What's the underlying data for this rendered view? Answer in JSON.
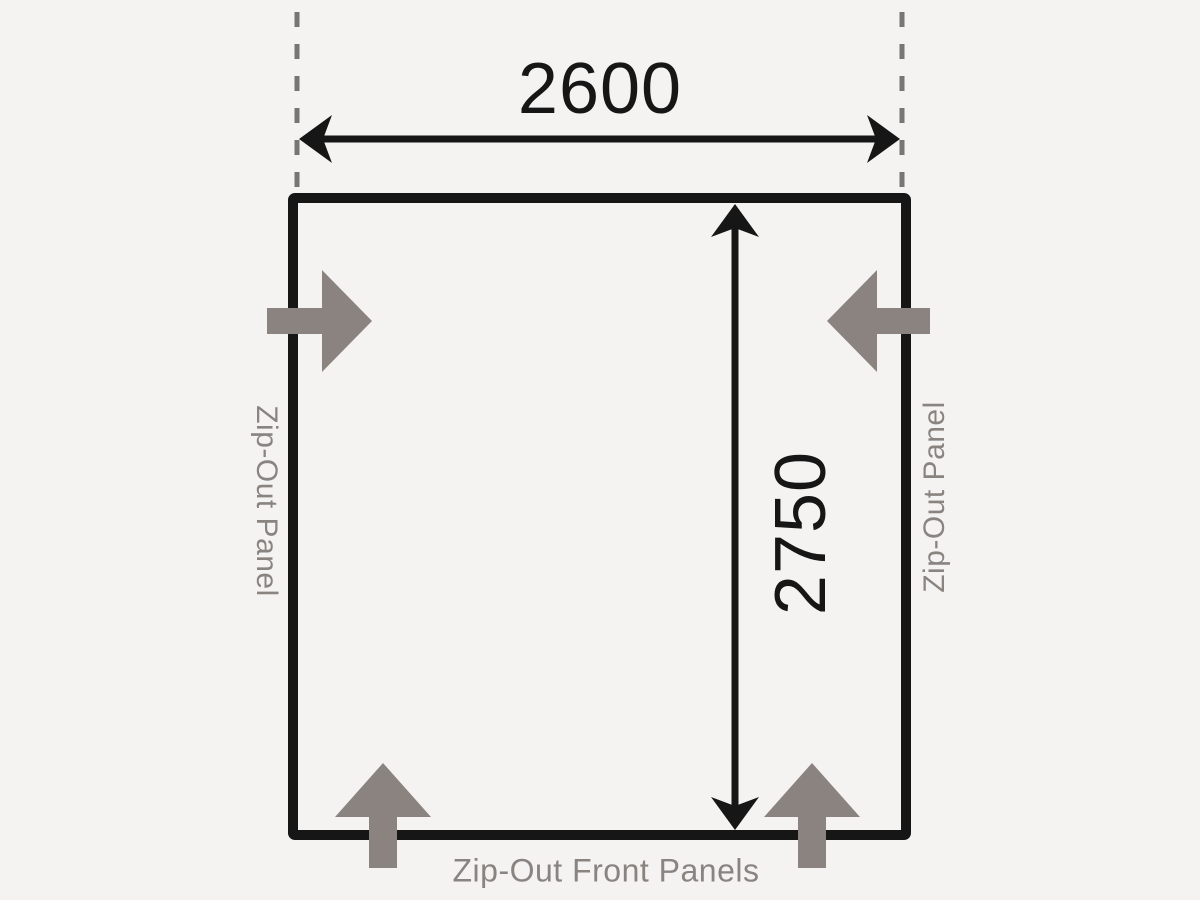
{
  "diagram": {
    "dimensions": {
      "width_label": "2600",
      "depth_label": "2750"
    },
    "labels": {
      "left_panel": "Zip-Out Panel",
      "right_panel": "Zip-Out Panel",
      "front_panels": "Zip-Out Front Panels"
    },
    "icons": [
      "zip-out-arrow-left",
      "zip-out-arrow-right",
      "zip-out-arrow-bottom-left",
      "zip-out-arrow-bottom-right"
    ],
    "colors": {
      "background": "#f4f3f2",
      "line": "#161616",
      "arrow": "#8b837f",
      "label_text": "#8a8480",
      "dashed_guide": "#767676",
      "dimension_text": "#161616"
    }
  }
}
